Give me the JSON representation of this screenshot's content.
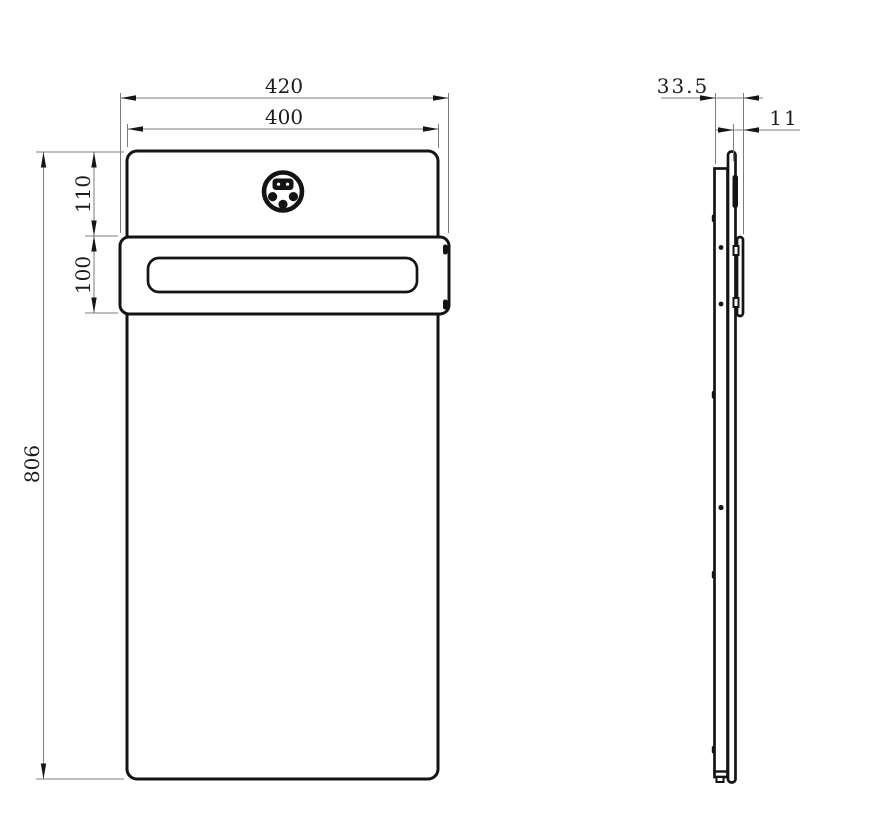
{
  "drawing": {
    "ink_color": "#141414",
    "dimension_line_color": "#7d7d7d"
  },
  "dimensions": {
    "front": {
      "bracket_width": "420",
      "panel_width": "400",
      "top_offset": "110",
      "bracket_height": "100",
      "panel_height": "806"
    },
    "side": {
      "total_depth": "33.5",
      "bracket_depth": "11"
    }
  }
}
